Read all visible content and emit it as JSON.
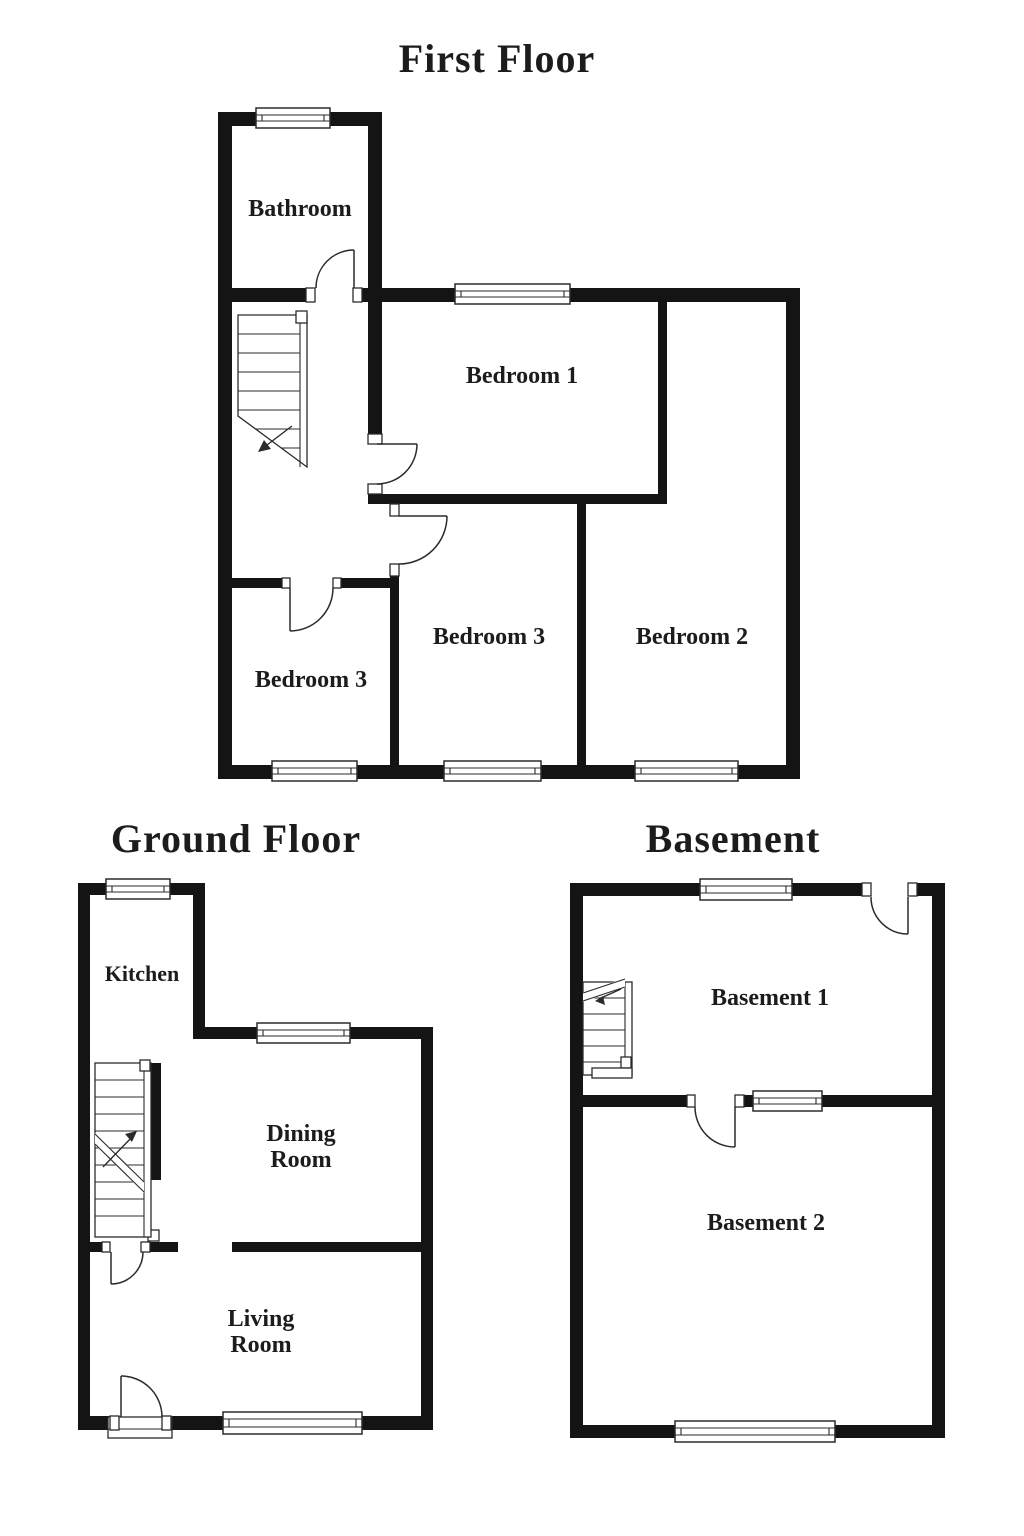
{
  "palette": {
    "background": "#ffffff",
    "wall": "#141414",
    "line": "#2b2b2b",
    "text": "#1c1c1c"
  },
  "floors": {
    "first": {
      "title": "First Floor",
      "rooms": {
        "bathroom": "Bathroom",
        "bedroom1": "Bedroom 1",
        "bedroom2": "Bedroom 2",
        "bedroom3_middle": "Bedroom 3",
        "bedroom3_left": "Bedroom 3"
      }
    },
    "ground": {
      "title": "Ground Floor",
      "rooms": {
        "kitchen": "Kitchen",
        "dining_line1": "Dining",
        "dining_line2": "Room",
        "living_line1": "Living",
        "living_line2": "Room"
      }
    },
    "basement": {
      "title": "Basement",
      "rooms": {
        "basement1": "Basement 1",
        "basement2": "Basement 2"
      }
    }
  }
}
